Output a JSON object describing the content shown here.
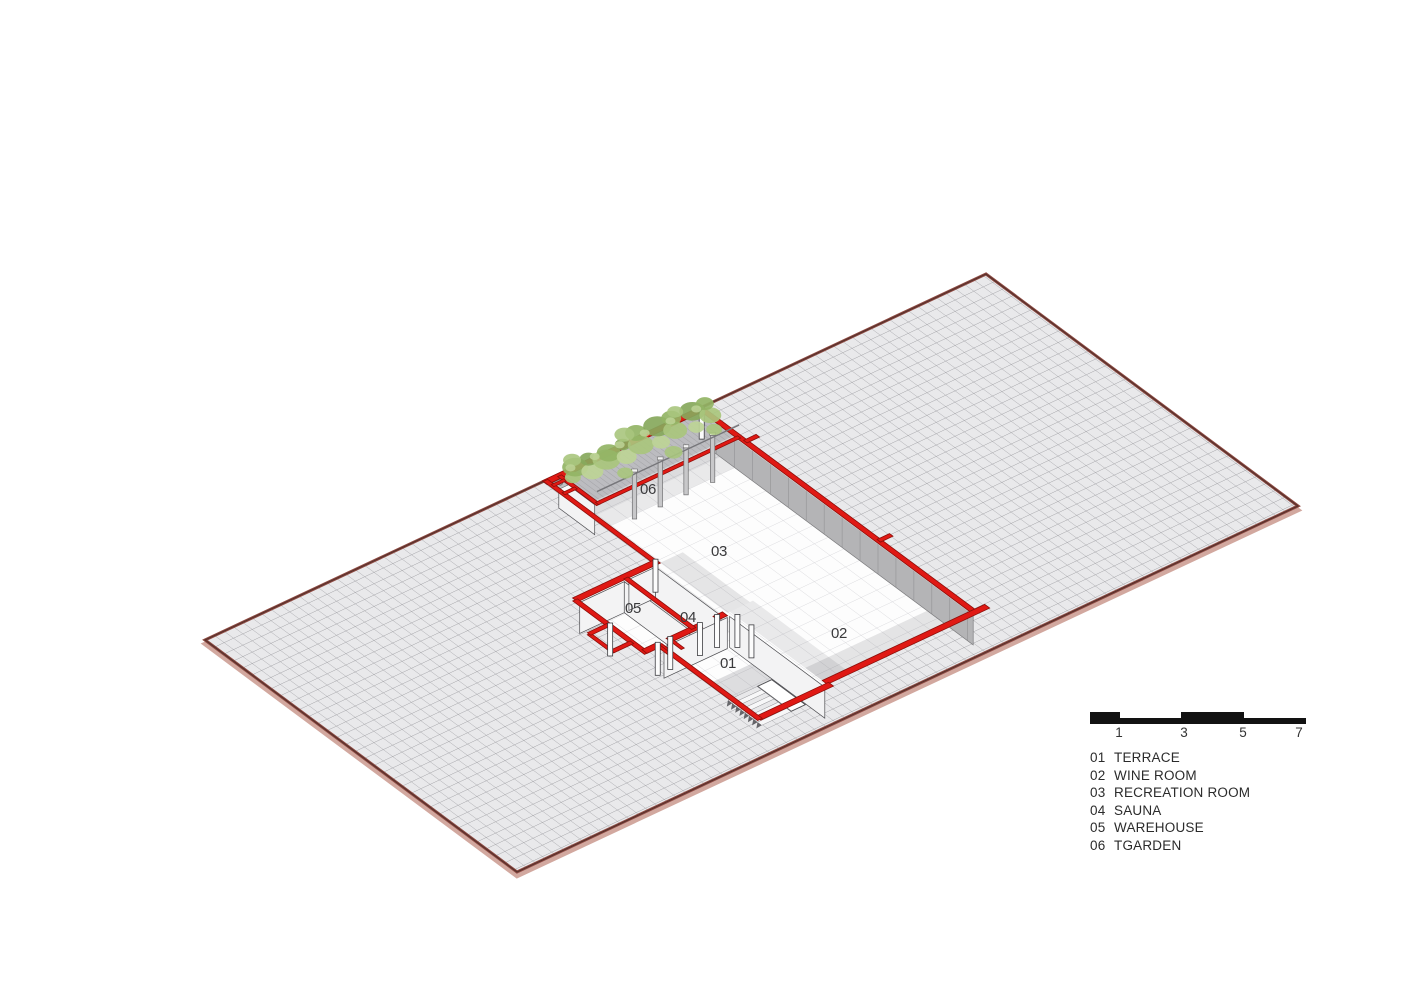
{
  "rooms": [
    {
      "num": "01",
      "name": "TERRACE"
    },
    {
      "num": "02",
      "name": "WINE ROOM"
    },
    {
      "num": "03",
      "name": "RECREATION ROOM"
    },
    {
      "num": "04",
      "name": "SAUNA"
    },
    {
      "num": "05",
      "name": "WAREHOUSE"
    },
    {
      "num": "06",
      "name": "TGARDEN"
    }
  ],
  "scale_bar": {
    "labels": [
      "1",
      "3",
      "5",
      "7"
    ]
  },
  "colors": {
    "wall_red": "#e01914",
    "wall_red_outline": "#8c0f0a",
    "plane_edge": "#8e4a42",
    "plane_edge_dark": "#55302b",
    "plane_edge_light": "#d2a89f",
    "plane_fill": "#e9e9eb",
    "plane_grid": "#a0a0a4",
    "floor_fill": "#fdfdfd",
    "floor_grid": "#cfcfd3",
    "wall_gray": "#b4b4b6",
    "wall_white": "#f3f3f4",
    "plant_green_1": "#a9c57d",
    "plant_green_2": "#93b465",
    "plant_green_3": "#bdd496",
    "plant_green_4": "#87a85c",
    "label_text": "#3a3a3c"
  }
}
